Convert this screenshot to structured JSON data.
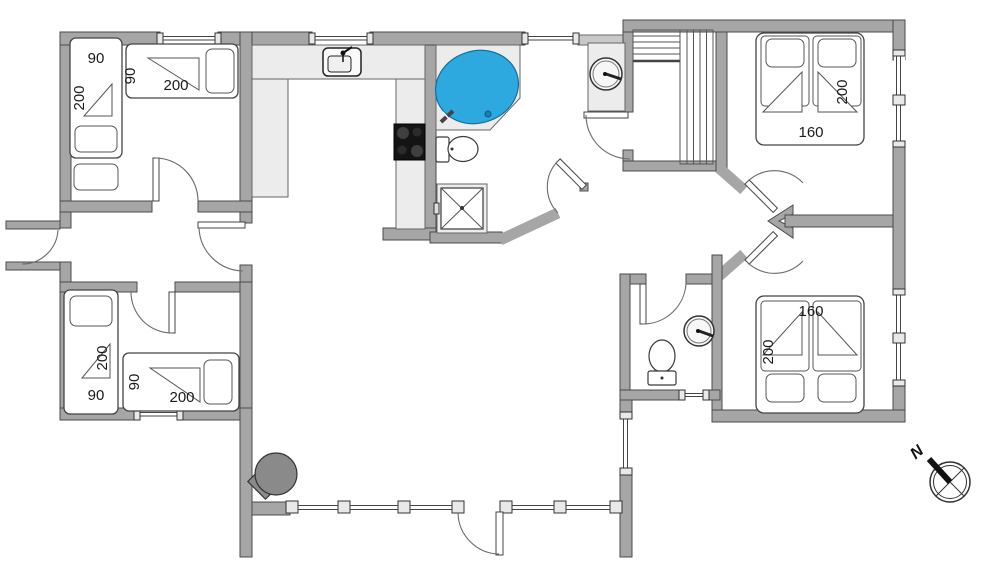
{
  "plan_type": "house-floor-plan",
  "colors": {
    "wall": "#a6a6a6",
    "wall_light": "#c9c9c9",
    "furniture": "#ececec",
    "spa_blue": "#2ea9e0",
    "stove_black": "#141414",
    "wood_stove": "#8a8a8a"
  },
  "rooms": {
    "bedroom_top_left": {
      "bed_vertical": {
        "width": "90",
        "length": "200"
      },
      "bed_horizontal": {
        "width": "90",
        "length": "200"
      }
    },
    "bedroom_bottom_left": {
      "bed_vertical": {
        "width": "90",
        "length": "200"
      },
      "bed_horizontal": {
        "width": "90",
        "length": "200"
      }
    },
    "bedroom_top_right": {
      "double_bed": {
        "width": "160",
        "length": "200"
      }
    },
    "bedroom_bottom_right": {
      "double_bed": {
        "width": "160",
        "length": "200"
      }
    }
  },
  "compass": {
    "north_label": "N"
  }
}
